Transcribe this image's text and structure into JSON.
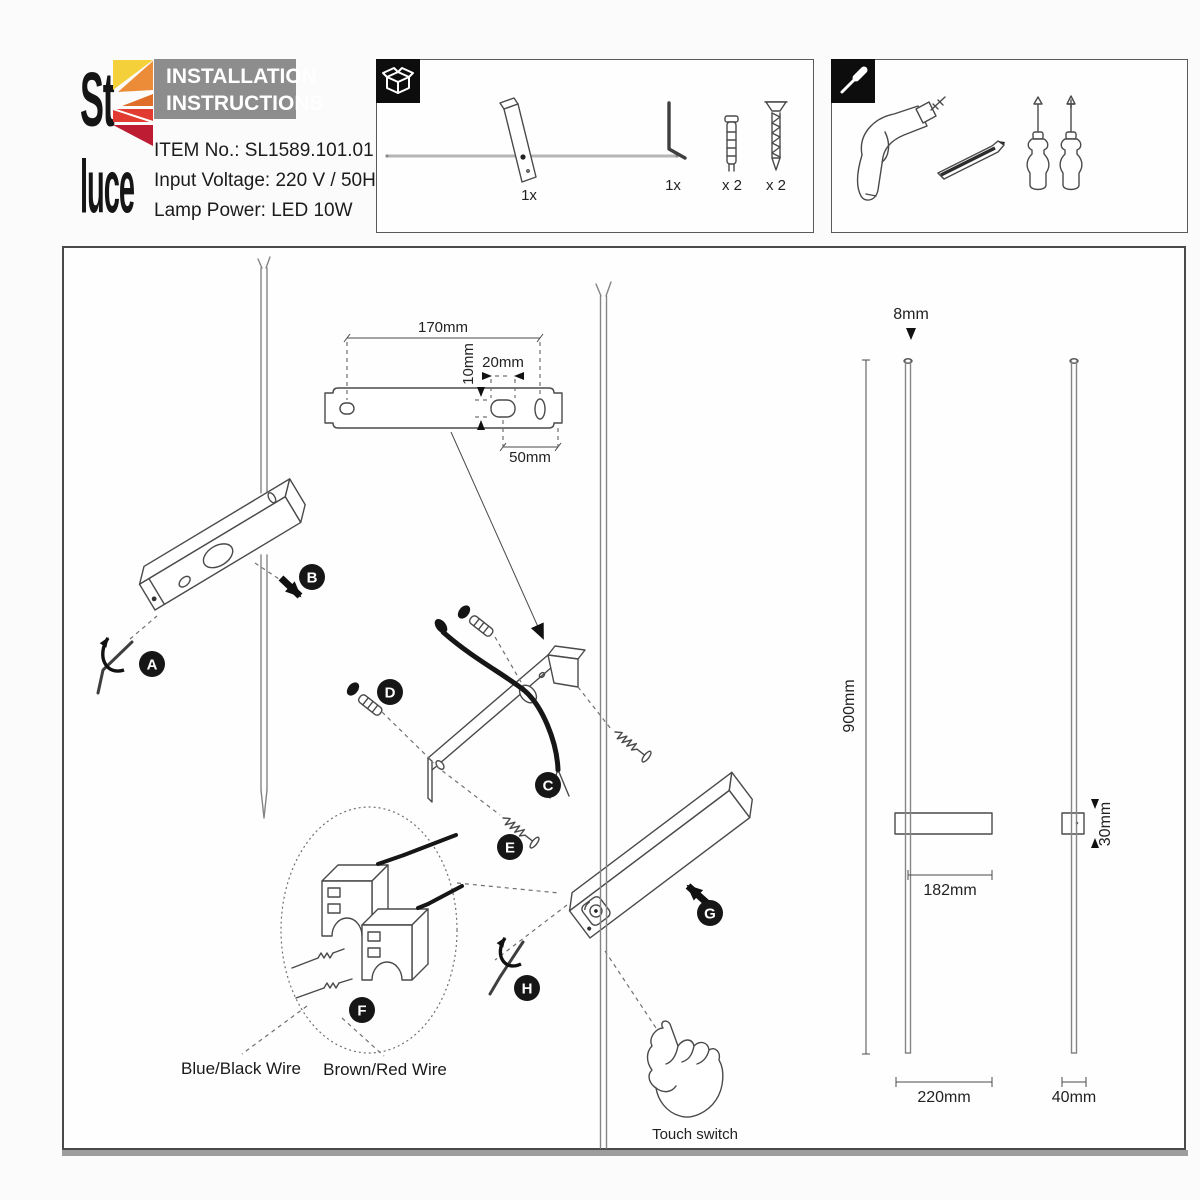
{
  "brand": {
    "logo_top": "St",
    "logo_bottom": "luce"
  },
  "header": {
    "title_line1": "INSTALLATION",
    "title_line2": "INSTRUCTIONS",
    "item_no": "ITEM No.: SL1589.101.01",
    "input_voltage": "Input Voltage: 220 V / 50Hz",
    "lamp_power": "Lamp Power: LED 10W"
  },
  "parts_box": {
    "lamp_qty": "1x",
    "hex_key_qty": "1x",
    "anchor_qty": "x 2",
    "screw_qty": "x 2"
  },
  "steps": {
    "a": "A",
    "b": "B",
    "c": "C",
    "d": "D",
    "e": "E",
    "f": "F",
    "g": "G",
    "h": "H"
  },
  "dimensions": {
    "bracket_length": "170mm",
    "hole_height": "10mm",
    "hole_width": "20mm",
    "hole_offset": "50mm",
    "rod_diameter": "8mm",
    "fixture_height": "900mm",
    "body_offset": "182mm",
    "body_height": "30mm",
    "body_length": "220mm",
    "side_width": "40mm"
  },
  "wiring": {
    "blue_black": "Blue/Black Wire",
    "brown_red": "Brown/Red Wire"
  },
  "touch": {
    "label": "Touch switch"
  },
  "colors": {
    "logo_yellow": "#f4d03b",
    "logo_orange": "#ec8c38",
    "logo_dark_orange": "#df6e28",
    "logo_red": "#e23b31",
    "logo_crimson": "#bd1c33",
    "header_bg": "#8d8d8d",
    "ink": "#3d3d3d"
  }
}
